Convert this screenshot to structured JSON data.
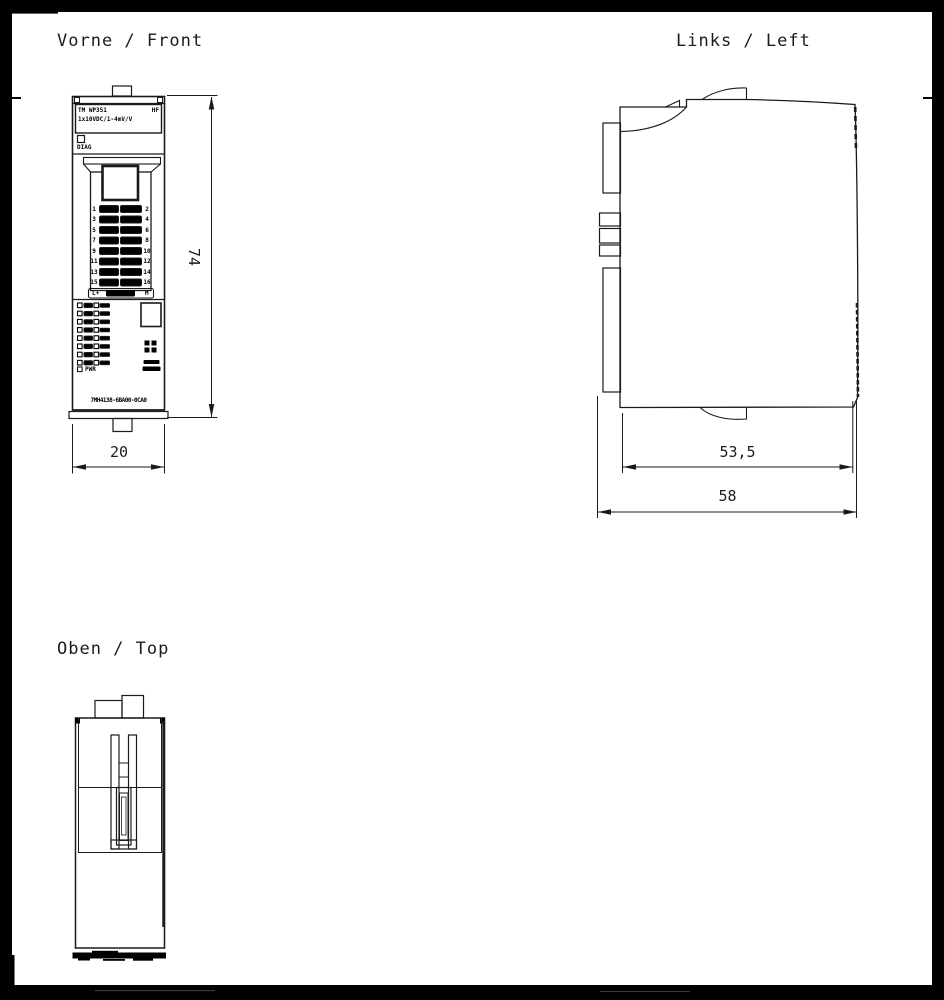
{
  "labels": {
    "front_view": "Vorne / Front",
    "left_view": "Links / Left",
    "top_view": "Oben / Top"
  },
  "dimensions": {
    "front_height": "74",
    "front_width": "20",
    "left_depth_rail": "53,5",
    "left_depth_total": "58"
  },
  "module": {
    "type_line1_left": "TM WP351",
    "type_line1_right": "HF",
    "type_line2": "1x10VDC/1-4mV/V",
    "diag_label": "DIAG",
    "pwr_label": "PWR",
    "part_number": "7MH4138-6BA00-0CA0",
    "terminal_bottom_left": "L+",
    "terminal_bottom_right": "M",
    "terminals_left": [
      "1",
      "3",
      "5",
      "7",
      "9",
      "11",
      "13",
      "15"
    ],
    "terminals_right": [
      "2",
      "4",
      "6",
      "8",
      "10",
      "12",
      "14",
      "16"
    ]
  },
  "colors": {
    "line": "#1a1a1a",
    "frame": "#000000",
    "background": "#ffffff"
  }
}
